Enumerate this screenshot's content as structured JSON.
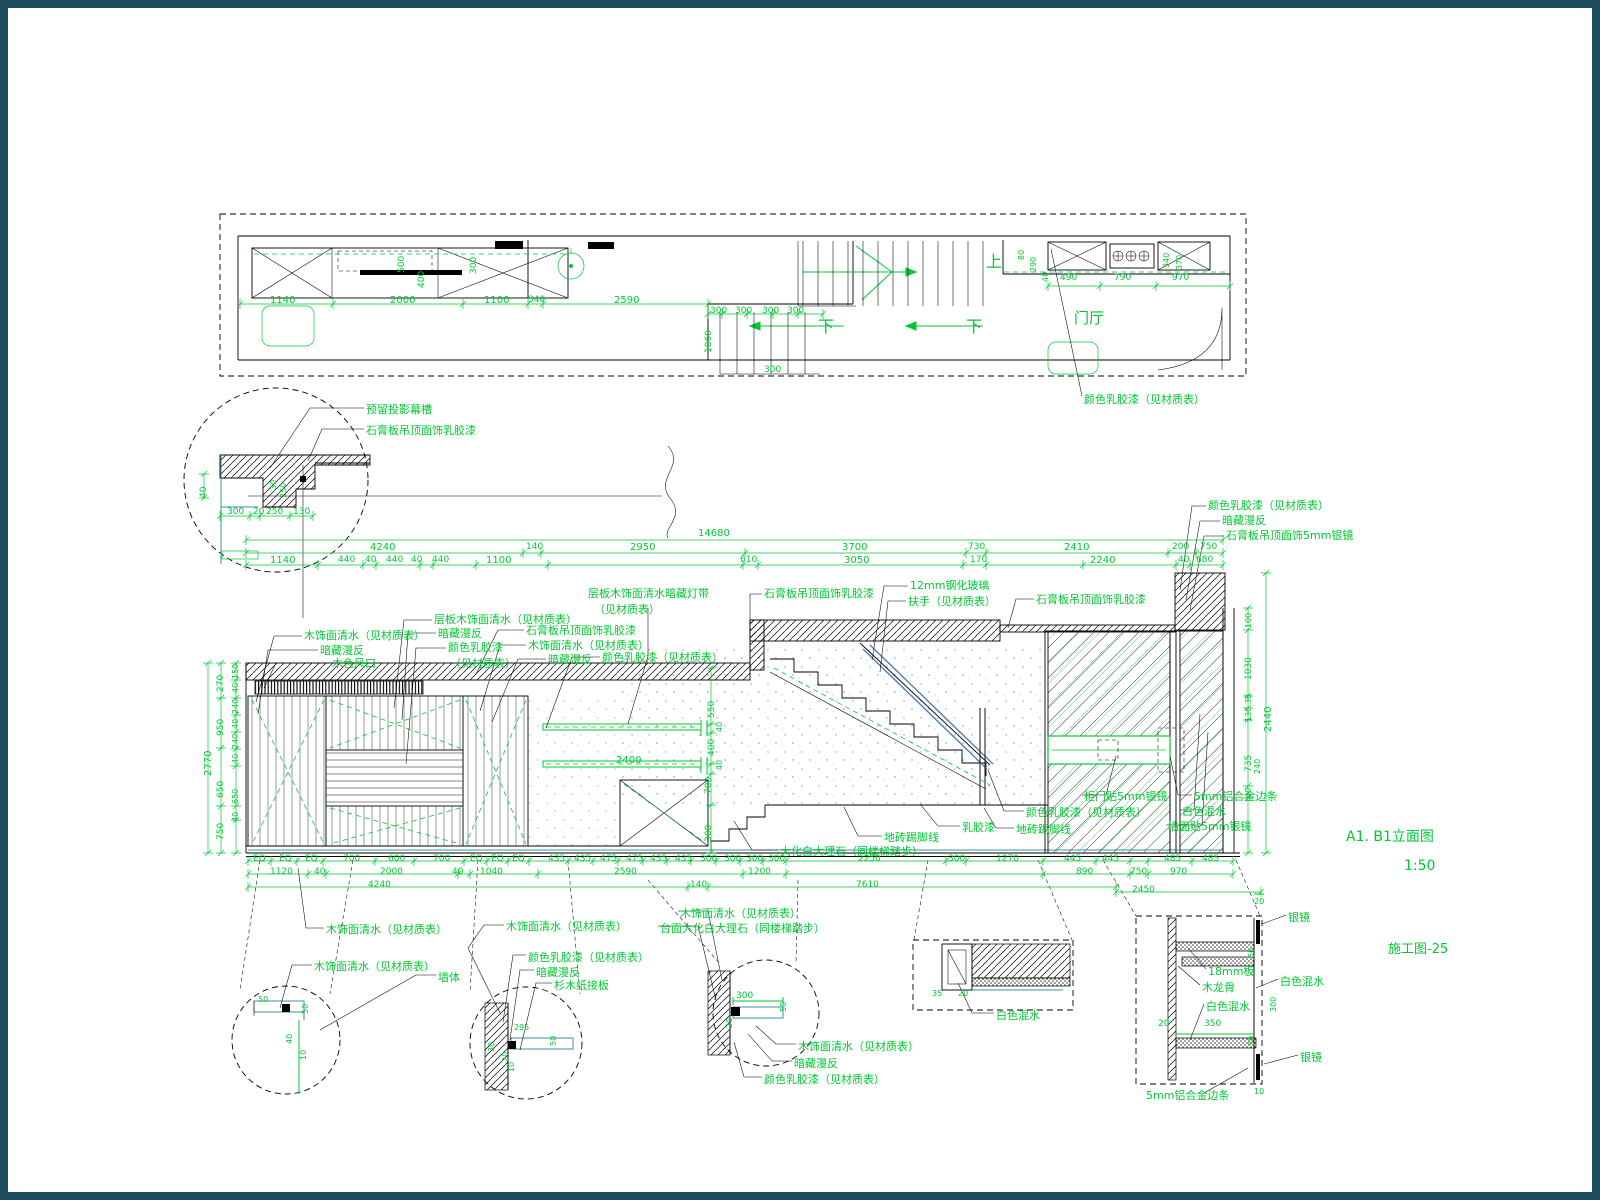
{
  "meta": {
    "title": "A1. B1立面图",
    "scale": "1:50",
    "sheet": "施工图-25"
  },
  "colors": {
    "annotation_green": "#00c832",
    "line_black": "#000000",
    "teal_accent": "#3d8fa0",
    "glass_blue": "#4f81bd",
    "frame": "#1d4e60"
  },
  "drawing": {
    "type": "interior elevation construction drawing",
    "views": [
      "ceiling plan strip",
      "ceiling cove detail circle",
      "A1.B1 elevation",
      "joinery detail circles",
      "mirror cabinet section detail"
    ]
  },
  "plan": {
    "stair_up_label": "上",
    "stair_down_labels": [
      "下",
      "下"
    ],
    "room_label": "门厅",
    "callout": "颜色乳胶漆（见材质表）"
  },
  "annotations": [
    {
      "t": "上",
      "x": 978,
      "y": 246,
      "s": 16,
      "k": "label"
    },
    {
      "t": "下",
      "x": 810,
      "y": 311,
      "s": 16,
      "k": "label"
    },
    {
      "t": "下",
      "x": 958,
      "y": 311,
      "s": 16,
      "k": "label"
    },
    {
      "t": "门厅",
      "x": 1066,
      "y": 303,
      "s": 15,
      "k": "label"
    },
    {
      "t": "颜色乳胶漆（见材质表）",
      "x": 1076,
      "y": 386,
      "k": "label"
    },
    {
      "t": "1140",
      "x": 262,
      "y": 288,
      "k": "dim"
    },
    {
      "t": "2000",
      "x": 382,
      "y": 288,
      "k": "dim"
    },
    {
      "t": "1100",
      "x": 476,
      "y": 288,
      "k": "dim"
    },
    {
      "t": "340",
      "x": 520,
      "y": 288,
      "s": 9,
      "k": "dim"
    },
    {
      "t": "2590",
      "x": 606,
      "y": 288,
      "k": "dim"
    },
    {
      "t": "300",
      "x": 702,
      "y": 299,
      "s": 9,
      "k": "dim"
    },
    {
      "t": "300",
      "x": 727,
      "y": 299,
      "s": 9,
      "k": "dim"
    },
    {
      "t": "300",
      "x": 754,
      "y": 299,
      "s": 9,
      "k": "dim"
    },
    {
      "t": "300",
      "x": 779,
      "y": 299,
      "s": 9,
      "k": "dim"
    },
    {
      "t": "300",
      "x": 756,
      "y": 358,
      "s": 9,
      "k": "dim"
    },
    {
      "t": "490",
      "x": 1052,
      "y": 266,
      "s": 9,
      "k": "dim"
    },
    {
      "t": "790",
      "x": 1106,
      "y": 266,
      "s": 9,
      "k": "dim"
    },
    {
      "t": "970",
      "x": 1164,
      "y": 266,
      "s": 9,
      "k": "dim"
    },
    {
      "t": "1060",
      "x": 697,
      "y": 345,
      "r": 1,
      "s": 9,
      "k": "dim"
    },
    {
      "t": "400",
      "x": 410,
      "y": 280,
      "r": 1,
      "s": 9,
      "k": "dim"
    },
    {
      "t": "500",
      "x": 390,
      "y": 265,
      "r": 1,
      "s": 9,
      "k": "dim"
    },
    {
      "t": "300",
      "x": 462,
      "y": 266,
      "r": 1,
      "s": 9,
      "k": "dim"
    },
    {
      "t": "80",
      "x": 1010,
      "y": 252,
      "r": 1,
      "s": 8,
      "k": "dim"
    },
    {
      "t": "290",
      "x": 1022,
      "y": 264,
      "r": 1,
      "s": 8,
      "k": "dim"
    },
    {
      "t": "40",
      "x": 1034,
      "y": 274,
      "r": 1,
      "s": 8,
      "k": "dim"
    },
    {
      "t": "340",
      "x": 1155,
      "y": 260,
      "r": 1,
      "s": 8,
      "k": "dim"
    },
    {
      "t": "370",
      "x": 1168,
      "y": 262,
      "r": 1,
      "s": 8,
      "k": "dim"
    },
    {
      "t": "预留投影幕槽",
      "x": 358,
      "y": 396,
      "k": "label"
    },
    {
      "t": "石膏板吊顶面饰乳胶漆",
      "x": 358,
      "y": 417,
      "k": "label"
    },
    {
      "t": "40",
      "x": 192,
      "y": 490,
      "r": 1,
      "s": 9,
      "k": "dim"
    },
    {
      "t": "300",
      "x": 219,
      "y": 500,
      "s": 9,
      "k": "dim"
    },
    {
      "t": "20",
      "x": 245,
      "y": 500,
      "s": 9,
      "k": "dim"
    },
    {
      "t": "250",
      "x": 258,
      "y": 500,
      "s": 9,
      "k": "dim"
    },
    {
      "t": "130",
      "x": 285,
      "y": 500,
      "s": 9,
      "k": "dim"
    },
    {
      "t": "30",
      "x": 262,
      "y": 482,
      "r": 1,
      "s": 8,
      "k": "dim"
    },
    {
      "t": "250",
      "x": 272,
      "y": 490,
      "r": 1,
      "s": 8,
      "k": "dim"
    },
    {
      "t": "14680",
      "x": 690,
      "y": 521,
      "k": "dim"
    },
    {
      "t": "4240",
      "x": 362,
      "y": 535,
      "k": "dim"
    },
    {
      "t": "140",
      "x": 518,
      "y": 535,
      "s": 9,
      "k": "dim"
    },
    {
      "t": "2950",
      "x": 622,
      "y": 535,
      "k": "dim"
    },
    {
      "t": "3700",
      "x": 834,
      "y": 535,
      "k": "dim"
    },
    {
      "t": "730",
      "x": 960,
      "y": 535,
      "s": 9,
      "k": "dim"
    },
    {
      "t": "2410",
      "x": 1056,
      "y": 535,
      "k": "dim"
    },
    {
      "t": "200",
      "x": 1164,
      "y": 535,
      "s": 9,
      "k": "dim"
    },
    {
      "t": "750",
      "x": 1192,
      "y": 535,
      "s": 9,
      "k": "dim"
    },
    {
      "t": "1140",
      "x": 262,
      "y": 548,
      "k": "dim"
    },
    {
      "t": "440",
      "x": 330,
      "y": 548,
      "s": 9,
      "k": "dim"
    },
    {
      "t": "40",
      "x": 357,
      "y": 548,
      "s": 9,
      "k": "dim"
    },
    {
      "t": "440",
      "x": 378,
      "y": 548,
      "s": 9,
      "k": "dim"
    },
    {
      "t": "40",
      "x": 403,
      "y": 548,
      "s": 9,
      "k": "dim"
    },
    {
      "t": "440",
      "x": 424,
      "y": 548,
      "s": 9,
      "k": "dim"
    },
    {
      "t": "1100",
      "x": 478,
      "y": 548,
      "k": "dim"
    },
    {
      "t": "610",
      "x": 732,
      "y": 548,
      "s": 9,
      "k": "dim"
    },
    {
      "t": "3050",
      "x": 836,
      "y": 548,
      "k": "dim"
    },
    {
      "t": "170",
      "x": 962,
      "y": 548,
      "s": 9,
      "k": "dim"
    },
    {
      "t": "2240",
      "x": 1082,
      "y": 548,
      "k": "dim"
    },
    {
      "t": "40",
      "x": 1170,
      "y": 548,
      "s": 9,
      "k": "dim"
    },
    {
      "t": "680",
      "x": 1188,
      "y": 548,
      "s": 9,
      "k": "dim"
    },
    {
      "t": "木饰面清水（见材质表）",
      "x": 296,
      "y": 622,
      "k": "label"
    },
    {
      "t": "暗藏漫反",
      "x": 312,
      "y": 637,
      "k": "label"
    },
    {
      "t": "木色风口",
      "x": 324,
      "y": 650,
      "k": "label"
    },
    {
      "t": "层板木饰面清水（见材质表）",
      "x": 426,
      "y": 606,
      "k": "label"
    },
    {
      "t": "暗藏漫反",
      "x": 430,
      "y": 620,
      "k": "label"
    },
    {
      "t": "颜色乳胶漆",
      "x": 440,
      "y": 634,
      "k": "label"
    },
    {
      "t": "（见材质表）",
      "x": 442,
      "y": 650,
      "k": "label"
    },
    {
      "t": "石膏板吊顶面饰乳胶漆",
      "x": 518,
      "y": 617,
      "k": "label"
    },
    {
      "t": "木饰面清水（见材质表）",
      "x": 520,
      "y": 632,
      "k": "label"
    },
    {
      "t": "暗藏漫反",
      "x": 540,
      "y": 646,
      "k": "label"
    },
    {
      "t": "颜色乳胶漆（见材质表）",
      "x": 594,
      "y": 644,
      "k": "label"
    },
    {
      "t": "层板木饰面清水暗藏灯带",
      "x": 580,
      "y": 580,
      "k": "label"
    },
    {
      "t": "（见材质表）",
      "x": 586,
      "y": 596,
      "k": "label"
    },
    {
      "t": "石膏板吊顶面饰乳胶漆",
      "x": 756,
      "y": 580,
      "k": "label"
    },
    {
      "t": "12mm钢化玻璃",
      "x": 902,
      "y": 572,
      "k": "label"
    },
    {
      "t": "扶手（见材质表）",
      "x": 900,
      "y": 588,
      "k": "label"
    },
    {
      "t": "石膏板吊顶面饰乳胶漆",
      "x": 1028,
      "y": 586,
      "k": "label"
    },
    {
      "t": "颜色乳胶漆（见材质表）",
      "x": 1200,
      "y": 492,
      "k": "label"
    },
    {
      "t": "暗藏漫反",
      "x": 1214,
      "y": 507,
      "k": "label"
    },
    {
      "t": "石膏板吊顶面饰5mm银镜",
      "x": 1218,
      "y": 522,
      "k": "label"
    },
    {
      "t": "2770",
      "x": 196,
      "y": 768,
      "r": 1,
      "k": "dim"
    },
    {
      "t": "270",
      "x": 209,
      "y": 684,
      "r": 1,
      "s": 9,
      "k": "dim"
    },
    {
      "t": "950",
      "x": 209,
      "y": 728,
      "r": 1,
      "s": 9,
      "k": "dim"
    },
    {
      "t": "650",
      "x": 209,
      "y": 790,
      "r": 1,
      "s": 9,
      "k": "dim"
    },
    {
      "t": "750",
      "x": 209,
      "y": 832,
      "r": 1,
      "s": 9,
      "k": "dim"
    },
    {
      "t": "150",
      "x": 224,
      "y": 671,
      "r": 1,
      "s": 8,
      "k": "dim"
    },
    {
      "t": "40",
      "x": 224,
      "y": 685,
      "r": 1,
      "s": 8,
      "k": "dim"
    },
    {
      "t": "240",
      "x": 224,
      "y": 706,
      "r": 1,
      "s": 8,
      "k": "dim"
    },
    {
      "t": "40",
      "x": 224,
      "y": 721,
      "r": 1,
      "s": 8,
      "k": "dim"
    },
    {
      "t": "240",
      "x": 224,
      "y": 741,
      "r": 1,
      "s": 8,
      "k": "dim"
    },
    {
      "t": "40",
      "x": 224,
      "y": 756,
      "r": 1,
      "s": 8,
      "k": "dim"
    },
    {
      "t": "650",
      "x": 224,
      "y": 796,
      "r": 1,
      "s": 8,
      "k": "dim"
    },
    {
      "t": "40",
      "x": 224,
      "y": 814,
      "r": 1,
      "s": 8,
      "k": "dim"
    },
    {
      "t": "550",
      "x": 700,
      "y": 710,
      "r": 1,
      "s": 9,
      "k": "dim"
    },
    {
      "t": "40",
      "x": 708,
      "y": 724,
      "r": 1,
      "s": 8,
      "k": "dim"
    },
    {
      "t": "400",
      "x": 700,
      "y": 748,
      "r": 1,
      "s": 9,
      "k": "dim"
    },
    {
      "t": "40",
      "x": 708,
      "y": 762,
      "r": 1,
      "s": 8,
      "k": "dim"
    },
    {
      "t": "2400",
      "x": 608,
      "y": 748,
      "k": "dim"
    },
    {
      "t": "700",
      "x": 697,
      "y": 786,
      "r": 1,
      "s": 9,
      "k": "dim"
    },
    {
      "t": "300",
      "x": 697,
      "y": 834,
      "r": 1,
      "s": 9,
      "k": "dim"
    },
    {
      "t": "100",
      "x": 1237,
      "y": 620,
      "r": 1,
      "s": 8,
      "k": "dim"
    },
    {
      "t": "1030",
      "x": 1237,
      "y": 672,
      "r": 1,
      "s": 9,
      "k": "dim"
    },
    {
      "t": "30",
      "x": 1237,
      "y": 696,
      "r": 1,
      "s": 8,
      "k": "dim"
    },
    {
      "t": "130",
      "x": 1237,
      "y": 714,
      "r": 1,
      "s": 8,
      "k": "dim"
    },
    {
      "t": "735",
      "x": 1237,
      "y": 764,
      "r": 1,
      "s": 9,
      "k": "dim"
    },
    {
      "t": "240",
      "x": 1246,
      "y": 766,
      "r": 1,
      "s": 8,
      "k": "dim"
    },
    {
      "t": "40",
      "x": 1237,
      "y": 790,
      "r": 1,
      "s": 8,
      "k": "dim"
    },
    {
      "t": "2440",
      "x": 1256,
      "y": 724,
      "r": 1,
      "k": "dim"
    },
    {
      "t": "地砖踢脚线",
      "x": 876,
      "y": 824,
      "k": "label"
    },
    {
      "t": "大化白大理石（同楼梯踏步）",
      "x": 772,
      "y": 838,
      "k": "label"
    },
    {
      "t": "乳胶漆",
      "x": 954,
      "y": 814,
      "k": "label"
    },
    {
      "t": "颜色乳胶漆（见材质表）",
      "x": 1018,
      "y": 799,
      "k": "label"
    },
    {
      "t": "地砖踢脚线",
      "x": 1008,
      "y": 816,
      "k": "label"
    },
    {
      "t": "柜门贴5mm银镜",
      "x": 1076,
      "y": 783,
      "k": "label"
    },
    {
      "t": "5mm铝合金边条",
      "x": 1186,
      "y": 783,
      "k": "label"
    },
    {
      "t": "白色混水",
      "x": 1174,
      "y": 798,
      "k": "label"
    },
    {
      "t": "墙面贴5mm银镜",
      "x": 1160,
      "y": 813,
      "k": "label"
    },
    {
      "t": "EQ",
      "x": 245,
      "y": 847,
      "s": 9,
      "k": "dim"
    },
    {
      "t": "EQ",
      "x": 271,
      "y": 847,
      "s": 9,
      "k": "dim"
    },
    {
      "t": "EQ",
      "x": 297,
      "y": 847,
      "s": 9,
      "k": "dim"
    },
    {
      "t": "700",
      "x": 335,
      "y": 847,
      "s": 9,
      "k": "dim"
    },
    {
      "t": "600",
      "x": 380,
      "y": 847,
      "s": 9,
      "k": "dim"
    },
    {
      "t": "700",
      "x": 425,
      "y": 847,
      "s": 9,
      "k": "dim"
    },
    {
      "t": "EQ",
      "x": 462,
      "y": 847,
      "s": 9,
      "k": "dim"
    },
    {
      "t": "EQ",
      "x": 483,
      "y": 847,
      "s": 9,
      "k": "dim"
    },
    {
      "t": "EQ",
      "x": 504,
      "y": 847,
      "s": 9,
      "k": "dim"
    },
    {
      "t": "435",
      "x": 540,
      "y": 847,
      "s": 9,
      "k": "dim"
    },
    {
      "t": "435",
      "x": 566,
      "y": 847,
      "s": 9,
      "k": "dim"
    },
    {
      "t": "475",
      "x": 592,
      "y": 847,
      "s": 9,
      "k": "dim"
    },
    {
      "t": "475",
      "x": 618,
      "y": 847,
      "s": 9,
      "k": "dim"
    },
    {
      "t": "435",
      "x": 642,
      "y": 847,
      "s": 9,
      "k": "dim"
    },
    {
      "t": "435",
      "x": 667,
      "y": 847,
      "s": 9,
      "k": "dim"
    },
    {
      "t": "300",
      "x": 692,
      "y": 847,
      "s": 9,
      "k": "dim"
    },
    {
      "t": "300",
      "x": 716,
      "y": 847,
      "s": 9,
      "k": "dim"
    },
    {
      "t": "300",
      "x": 738,
      "y": 847,
      "s": 9,
      "k": "dim"
    },
    {
      "t": "300",
      "x": 760,
      "y": 847,
      "s": 9,
      "k": "dim"
    },
    {
      "t": "2250",
      "x": 850,
      "y": 847,
      "s": 9,
      "k": "dim"
    },
    {
      "t": "300",
      "x": 940,
      "y": 847,
      "s": 9,
      "k": "dim"
    },
    {
      "t": "1270",
      "x": 988,
      "y": 847,
      "s": 9,
      "k": "dim"
    },
    {
      "t": "445",
      "x": 1056,
      "y": 847,
      "s": 9,
      "k": "dim"
    },
    {
      "t": "445",
      "x": 1094,
      "y": 847,
      "s": 9,
      "k": "dim"
    },
    {
      "t": "485",
      "x": 1156,
      "y": 847,
      "s": 9,
      "k": "dim"
    },
    {
      "t": "485",
      "x": 1194,
      "y": 847,
      "s": 9,
      "k": "dim"
    },
    {
      "t": "1120",
      "x": 262,
      "y": 860,
      "s": 9,
      "k": "dim"
    },
    {
      "t": "40",
      "x": 306,
      "y": 860,
      "s": 9,
      "k": "dim"
    },
    {
      "t": "2000",
      "x": 372,
      "y": 860,
      "s": 9,
      "k": "dim"
    },
    {
      "t": "40",
      "x": 444,
      "y": 860,
      "s": 9,
      "k": "dim"
    },
    {
      "t": "1040",
      "x": 472,
      "y": 860,
      "s": 9,
      "k": "dim"
    },
    {
      "t": "2590",
      "x": 606,
      "y": 860,
      "s": 9,
      "k": "dim"
    },
    {
      "t": "1200",
      "x": 740,
      "y": 860,
      "s": 9,
      "k": "dim"
    },
    {
      "t": "890",
      "x": 1068,
      "y": 860,
      "s": 9,
      "k": "dim"
    },
    {
      "t": "750",
      "x": 1122,
      "y": 860,
      "s": 9,
      "k": "dim"
    },
    {
      "t": "970",
      "x": 1162,
      "y": 860,
      "s": 9,
      "k": "dim"
    },
    {
      "t": "4240",
      "x": 360,
      "y": 873,
      "s": 9,
      "k": "dim"
    },
    {
      "t": "140",
      "x": 682,
      "y": 873,
      "s": 9,
      "k": "dim"
    },
    {
      "t": "7610",
      "x": 848,
      "y": 873,
      "s": 9,
      "k": "dim"
    },
    {
      "t": "2450",
      "x": 1124,
      "y": 878,
      "s": 9,
      "k": "dim"
    },
    {
      "t": "木饰面清水（见材质表）",
      "x": 318,
      "y": 916,
      "k": "label"
    },
    {
      "t": "木饰面清水（见材质表）",
      "x": 306,
      "y": 953,
      "k": "label"
    },
    {
      "t": "墙体",
      "x": 430,
      "y": 964,
      "k": "label"
    },
    {
      "t": "木饰面清水（见材质表）",
      "x": 498,
      "y": 913,
      "k": "label"
    },
    {
      "t": "颜色乳胶漆（见材质表）",
      "x": 520,
      "y": 944,
      "k": "label"
    },
    {
      "t": "暗藏漫反",
      "x": 528,
      "y": 959,
      "k": "label"
    },
    {
      "t": "杉木纸接板",
      "x": 546,
      "y": 972,
      "k": "label"
    },
    {
      "t": "木饰面清水（见材质表）",
      "x": 672,
      "y": 900,
      "k": "label"
    },
    {
      "t": "台面大化白大理石（同楼梯踏步）",
      "x": 652,
      "y": 915,
      "k": "label"
    },
    {
      "t": "木饰面清水（见材质表）",
      "x": 790,
      "y": 1033,
      "k": "label"
    },
    {
      "t": "暗藏漫反",
      "x": 786,
      "y": 1050,
      "k": "label"
    },
    {
      "t": "颜色乳胶漆（见材质表）",
      "x": 756,
      "y": 1066,
      "k": "label"
    },
    {
      "t": "白色混水",
      "x": 988,
      "y": 1002,
      "k": "label"
    },
    {
      "t": "300",
      "x": 728,
      "y": 984,
      "s": 9,
      "k": "dim"
    },
    {
      "t": "50",
      "x": 772,
      "y": 1004,
      "r": 1,
      "s": 8,
      "k": "dim"
    },
    {
      "t": "20",
      "x": 718,
      "y": 1020,
      "r": 1,
      "s": 8,
      "k": "dim"
    },
    {
      "t": "50",
      "x": 250,
      "y": 988,
      "s": 8,
      "k": "dim"
    },
    {
      "t": "50",
      "x": 294,
      "y": 1006,
      "r": 1,
      "s": 8,
      "k": "dim"
    },
    {
      "t": "40",
      "x": 278,
      "y": 1036,
      "r": 1,
      "s": 8,
      "k": "dim"
    },
    {
      "t": "10",
      "x": 292,
      "y": 1052,
      "r": 1,
      "s": 8,
      "k": "dim"
    },
    {
      "t": "295",
      "x": 506,
      "y": 1016,
      "s": 8,
      "k": "dim"
    },
    {
      "t": "50",
      "x": 542,
      "y": 1038,
      "r": 1,
      "s": 8,
      "k": "dim"
    },
    {
      "t": "30",
      "x": 480,
      "y": 1044,
      "r": 1,
      "s": 8,
      "k": "dim"
    },
    {
      "t": "20",
      "x": 494,
      "y": 1054,
      "r": 1,
      "s": 8,
      "k": "dim"
    },
    {
      "t": "10",
      "x": 500,
      "y": 1064,
      "r": 1,
      "s": 8,
      "k": "dim"
    },
    {
      "t": "35",
      "x": 924,
      "y": 982,
      "s": 8,
      "k": "dim"
    },
    {
      "t": "20",
      "x": 950,
      "y": 982,
      "s": 8,
      "k": "dim"
    },
    {
      "t": "银镜",
      "x": 1280,
      "y": 904,
      "k": "label"
    },
    {
      "t": "18mm板",
      "x": 1200,
      "y": 958,
      "k": "label"
    },
    {
      "t": "木龙骨",
      "x": 1194,
      "y": 974,
      "k": "label"
    },
    {
      "t": "白色混水",
      "x": 1198,
      "y": 993,
      "k": "label"
    },
    {
      "t": "白色混水",
      "x": 1272,
      "y": 968,
      "k": "label"
    },
    {
      "t": "银镜",
      "x": 1292,
      "y": 1044,
      "k": "label"
    },
    {
      "t": "5mm铝合金边条",
      "x": 1138,
      "y": 1082,
      "k": "label"
    },
    {
      "t": "350",
      "x": 1196,
      "y": 1012,
      "s": 9,
      "k": "dim"
    },
    {
      "t": "20",
      "x": 1150,
      "y": 1012,
      "s": 9,
      "k": "dim"
    },
    {
      "t": "20",
      "x": 1246,
      "y": 890,
      "s": 8,
      "k": "dim"
    },
    {
      "t": "300",
      "x": 1262,
      "y": 1004,
      "r": 1,
      "s": 8,
      "k": "dim"
    },
    {
      "t": "50",
      "x": 1240,
      "y": 950,
      "r": 1,
      "s": 8,
      "k": "dim"
    },
    {
      "t": "50",
      "x": 1240,
      "y": 1038,
      "r": 1,
      "s": 8,
      "k": "dim"
    },
    {
      "t": "10",
      "x": 1246,
      "y": 1080,
      "s": 8,
      "k": "dim"
    }
  ]
}
